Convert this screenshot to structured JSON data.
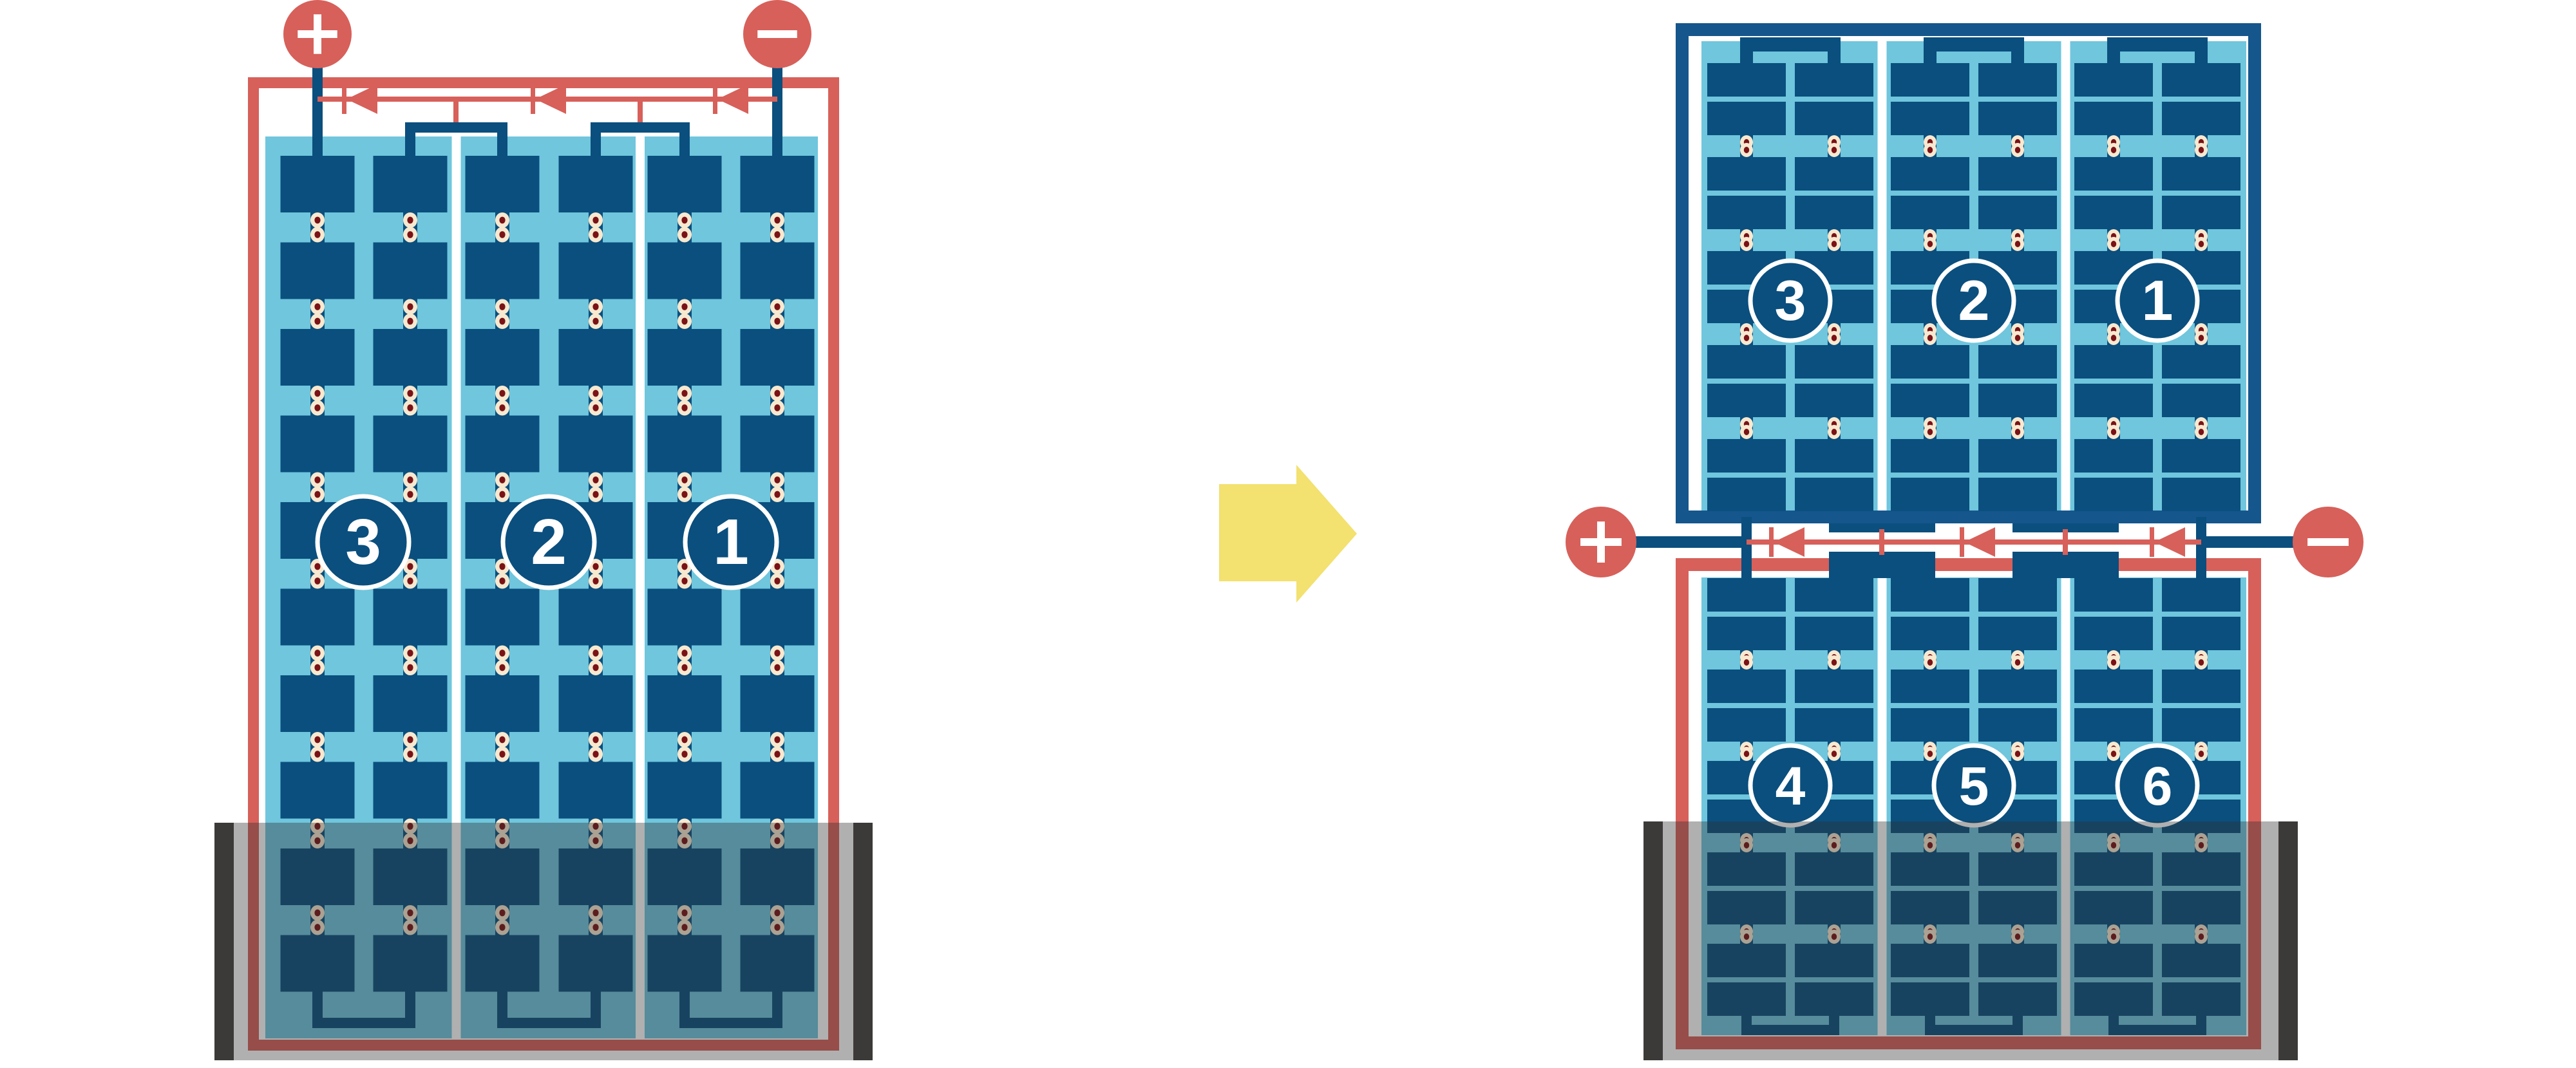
{
  "diagram": {
    "type": "solar-panel-bypass-diode-wiring-comparison",
    "terminals": {
      "positive_label": "+",
      "negative_label": "−"
    },
    "left_panel": {
      "substrings": [
        "3",
        "2",
        "1"
      ],
      "bypass_diodes": 3
    },
    "right_top_panel": {
      "substrings": [
        "3",
        "2",
        "1"
      ]
    },
    "right_bottom_panel": {
      "substrings": [
        "4",
        "5",
        "6"
      ],
      "bypass_diodes": 3
    },
    "colors": {
      "red": "#d7605a",
      "frame_navy": "#15568c",
      "navy": "#0a4f7e",
      "light_blue": "#6fc6dd",
      "cream": "#f7e9d0",
      "maroon": "#7a1216",
      "yellow": "#f3e170",
      "shade": "rgba(47,47,47,0.38)",
      "post": "#3c3a39",
      "white": "#ffffff"
    }
  }
}
